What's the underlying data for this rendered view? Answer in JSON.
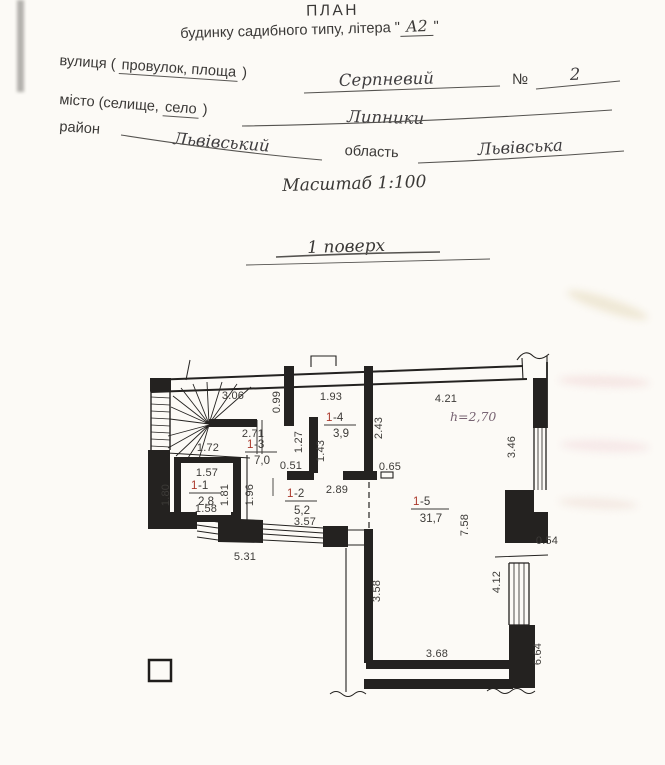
{
  "header": {
    "title": "ПЛАН",
    "subtitle_pre": "будинку садибного типу, літера \"",
    "subtitle_letter": "А2",
    "subtitle_post": "\"",
    "street_pre": "вулиця (",
    "street_u": "провулок, площа",
    "street_post": ")",
    "street_value": "Серпневий",
    "num_label": "№",
    "num_value": "2",
    "city_pre": "місто (селище,",
    "city_u": "село",
    "city_post": ")",
    "city_value": "Липники",
    "district_label": "район",
    "district_value": "Львівський",
    "region_label": "область",
    "region_value": "Львівська",
    "scale_line": "Масштаб 1:100",
    "floor_line": "1 поверх"
  },
  "plan": {
    "height_note": "h=2,70",
    "rooms": [
      {
        "red": "1",
        "rest": "-1",
        "area": "2,8"
      },
      {
        "red": "1",
        "rest": "-2",
        "area": "5,2"
      },
      {
        "red": "1",
        "rest": "-3",
        "area": "7,0"
      },
      {
        "red": "1",
        "rest": "-4",
        "area": "3,9"
      },
      {
        "red": "1",
        "rest": "-5",
        "area": "31,7"
      }
    ],
    "dims_h": [
      {
        "t": "3.06"
      },
      {
        "t": "1.93"
      },
      {
        "t": "4.21"
      },
      {
        "t": "2.71"
      },
      {
        "t": "1.72"
      },
      {
        "t": "0.51"
      },
      {
        "t": "0.65"
      },
      {
        "t": "1.57"
      },
      {
        "t": "2.89"
      },
      {
        "t": "1.58"
      },
      {
        "t": "3.57"
      },
      {
        "t": "5.31"
      },
      {
        "t": "0.54"
      },
      {
        "t": "3.68"
      }
    ],
    "dims_v": [
      {
        "t": "0.99"
      },
      {
        "t": "1.27"
      },
      {
        "t": "1.43"
      },
      {
        "t": "2.43"
      },
      {
        "t": "1.80"
      },
      {
        "t": "1.81"
      },
      {
        "t": "1.96"
      },
      {
        "t": "3.46"
      },
      {
        "t": "7.58"
      },
      {
        "t": "4.12"
      },
      {
        "t": "6.64"
      },
      {
        "t": "3.58"
      }
    ],
    "colors": {
      "ink": "#2e2c2a",
      "room_red": "#ab382b",
      "height_note": "#786473"
    }
  }
}
